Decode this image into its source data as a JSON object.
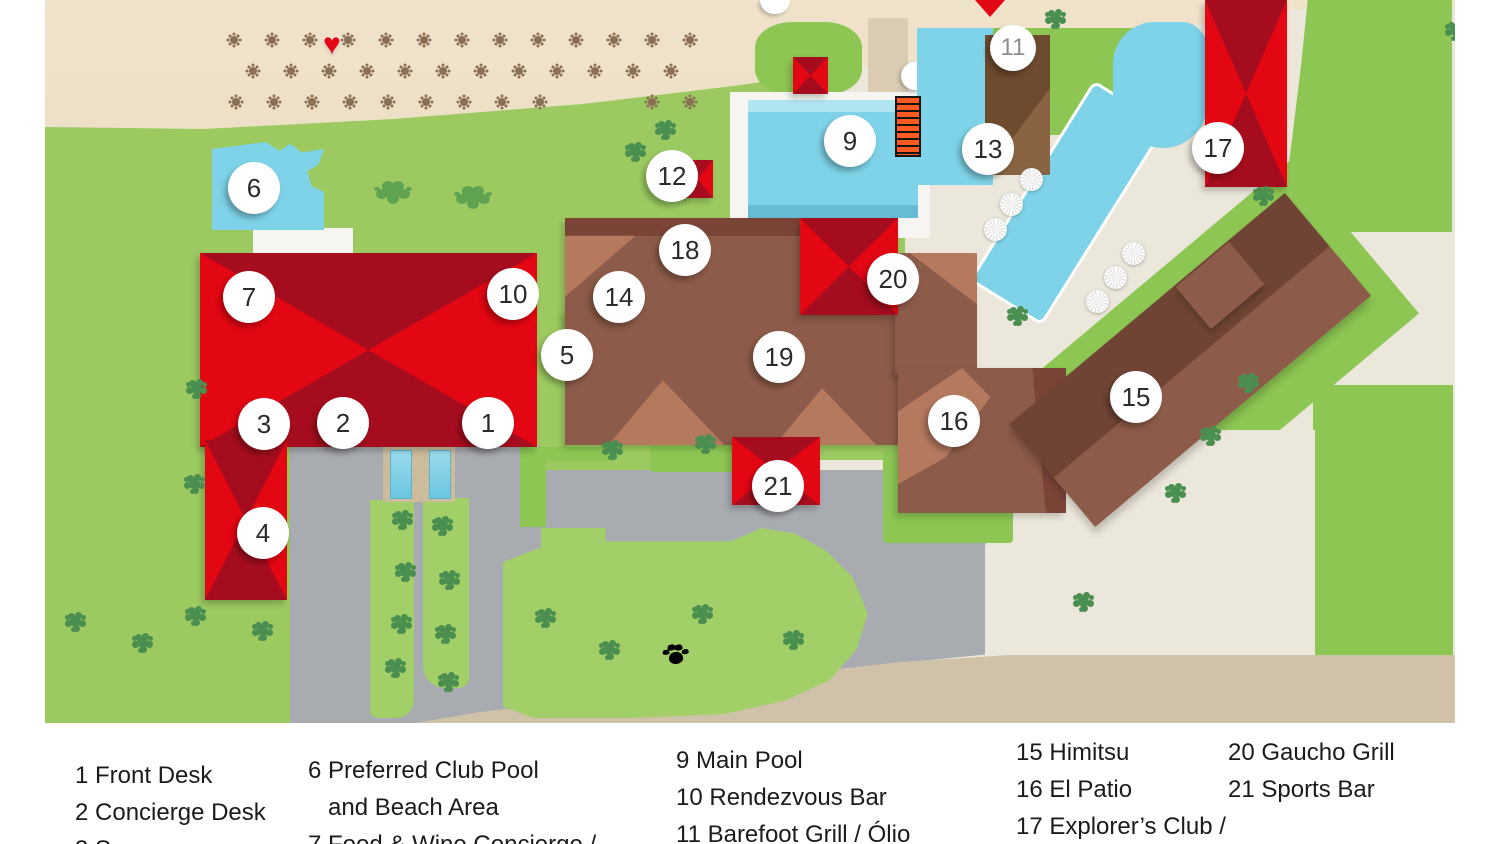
{
  "colors": {
    "red_bright": "#e30613",
    "red_dark": "#a50d1e",
    "brown": "#8d5b49",
    "brown_dark": "#7a4437",
    "brown_deep": "#6f4434",
    "salmon": "#b5795e",
    "brown_grill": "#6e4a2e",
    "brown_grill_light": "#8a6442",
    "pool": "#7ed3e8",
    "sand": "#f0e3cb",
    "sand_deep": "#e5d2b0",
    "grass": "#9cca60",
    "grass_bright": "#8dc653",
    "grass_island": "#a3cf69",
    "path": "#ece7db",
    "road": "#a8abaf",
    "road_tan": "#cfc2a8",
    "deck": "#f6f5f1",
    "tree": "#4a8f4f",
    "bush": "#5fa351",
    "palm": "#8a6f55",
    "marker_text": "#2b2b2b"
  },
  "map": {
    "markers": [
      {
        "label": "1",
        "x": 488,
        "y": 423
      },
      {
        "label": "2",
        "x": 343,
        "y": 423
      },
      {
        "label": "3",
        "x": 264,
        "y": 424
      },
      {
        "label": "4",
        "x": 263,
        "y": 533
      },
      {
        "label": "5",
        "x": 567,
        "y": 355
      },
      {
        "label": "6",
        "x": 254,
        "y": 188
      },
      {
        "label": "7",
        "x": 249,
        "y": 297
      },
      {
        "label": "9",
        "x": 850,
        "y": 141
      },
      {
        "label": "10",
        "x": 513,
        "y": 294
      },
      {
        "label": "11",
        "x": 1013,
        "y": 48,
        "muted": true
      },
      {
        "label": "12",
        "x": 672,
        "y": 176
      },
      {
        "label": "13",
        "x": 988,
        "y": 149
      },
      {
        "label": "14",
        "x": 619,
        "y": 297
      },
      {
        "label": "15",
        "x": 1136,
        "y": 397
      },
      {
        "label": "16",
        "x": 954,
        "y": 421
      },
      {
        "label": "17",
        "x": 1218,
        "y": 148
      },
      {
        "label": "18",
        "x": 685,
        "y": 250
      },
      {
        "label": "19",
        "x": 779,
        "y": 357
      },
      {
        "label": "20",
        "x": 893,
        "y": 279
      },
      {
        "label": "21",
        "x": 778,
        "y": 486
      }
    ],
    "icons": {
      "heart": "♥",
      "paw": "paw-print",
      "pin": "map-pin-tip"
    }
  },
  "legend": {
    "columns": [
      {
        "x": 75,
        "top": 757,
        "lines": [
          "1 Front Desk",
          "2 Concierge Desk",
          "3 Spa"
        ]
      },
      {
        "x": 308,
        "top": 752,
        "lines": [
          "6 Preferred Club Pool",
          "   and Beach Area",
          "7 Food & Wine Concierge /"
        ]
      },
      {
        "x": 676,
        "top": 742,
        "lines": [
          "9 Main Pool",
          "10 Rendezvous Bar",
          "11 Barefoot Grill / Ólio"
        ]
      },
      {
        "x": 1016,
        "top": 734,
        "lines": [
          "15 Himitsu",
          "16 El Patio",
          "17 Explorer’s Club /"
        ]
      },
      {
        "x": 1228,
        "top": 734,
        "lines": [
          "20 Gaucho Grill",
          "21 Sports Bar"
        ]
      }
    ]
  }
}
